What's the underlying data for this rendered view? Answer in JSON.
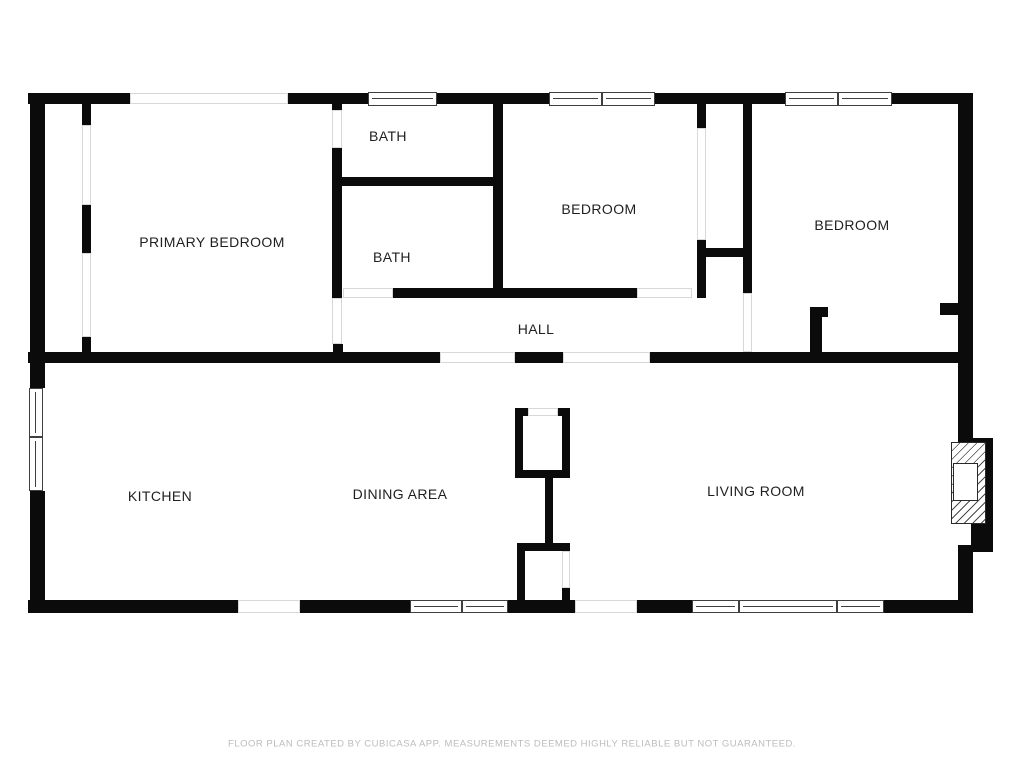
{
  "floorplan": {
    "rooms": {
      "primary_bedroom": "PRIMARY BEDROOM",
      "bath_upper": "BATH",
      "bath_lower": "BATH",
      "bedroom_middle": "BEDROOM",
      "bedroom_right": "BEDROOM",
      "hall": "HALL",
      "kitchen": "KITCHEN",
      "dining_area": "DINING AREA",
      "living_room": "LIVING ROOM"
    },
    "footer": "FLOOR PLAN CREATED BY CUBICASA APP. MEASUREMENTS DEEMED HIGHLY RELIABLE BUT NOT GUARANTEED.",
    "colors": {
      "wall": "#0b0b0b",
      "window_frame": "#3f3f3f",
      "opening_outline": "#d8d8d8",
      "label_text": "#1f1f1f",
      "footer_text": "#bcbcbc",
      "background": "#ffffff"
    }
  }
}
